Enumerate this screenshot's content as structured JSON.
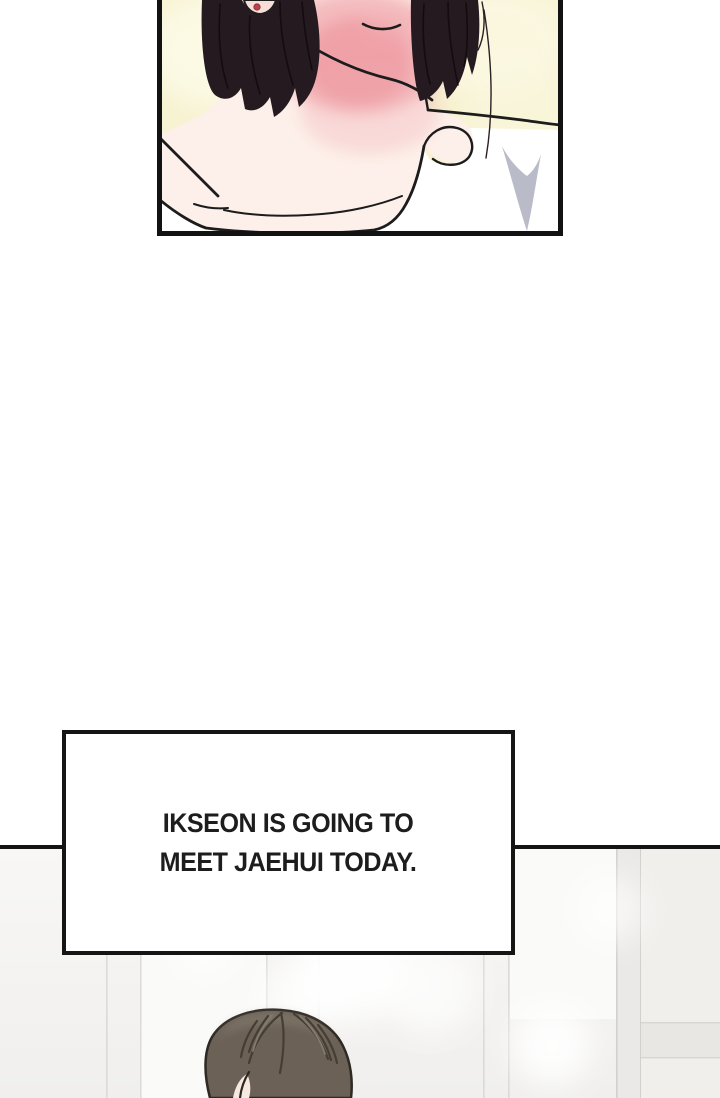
{
  "page": {
    "kind": "webtoon comic page",
    "background": "#ffffff"
  },
  "narration_box": {
    "line1": "IKSEON IS GOING TO",
    "line2": "MEET JAEHUI TODAY.",
    "text_color": "#1d1d1d",
    "border_color": "#151515",
    "background": "#ffffff"
  },
  "panels": [
    {
      "id": "top",
      "scene": "close-up of a person's chin, neck and bare shoulders, black bob hair, blushing neck, white shirt",
      "colors": {
        "background": "#f7f2d1",
        "hair": "#251a1f",
        "skin": "#fdf0ea",
        "blush": "#ef9aa2",
        "line": "#1c1c1c",
        "shirt": "#ffffff",
        "collar_shadow": "#b9bcc8",
        "earring": "#bf3f4b",
        "border": "#121212"
      }
    },
    {
      "id": "bottom",
      "scene": "top of a person's head with swept brown hair in a bright white room, cut off by page edge",
      "colors": {
        "wall": "#f5f4f2",
        "wall_line": "#d8d6d3",
        "hair": "#6b6157",
        "hair_dark": "#453e35",
        "hair_light": "#958d7d",
        "skin": "#f7e9e1",
        "border": "#141414"
      }
    }
  ]
}
